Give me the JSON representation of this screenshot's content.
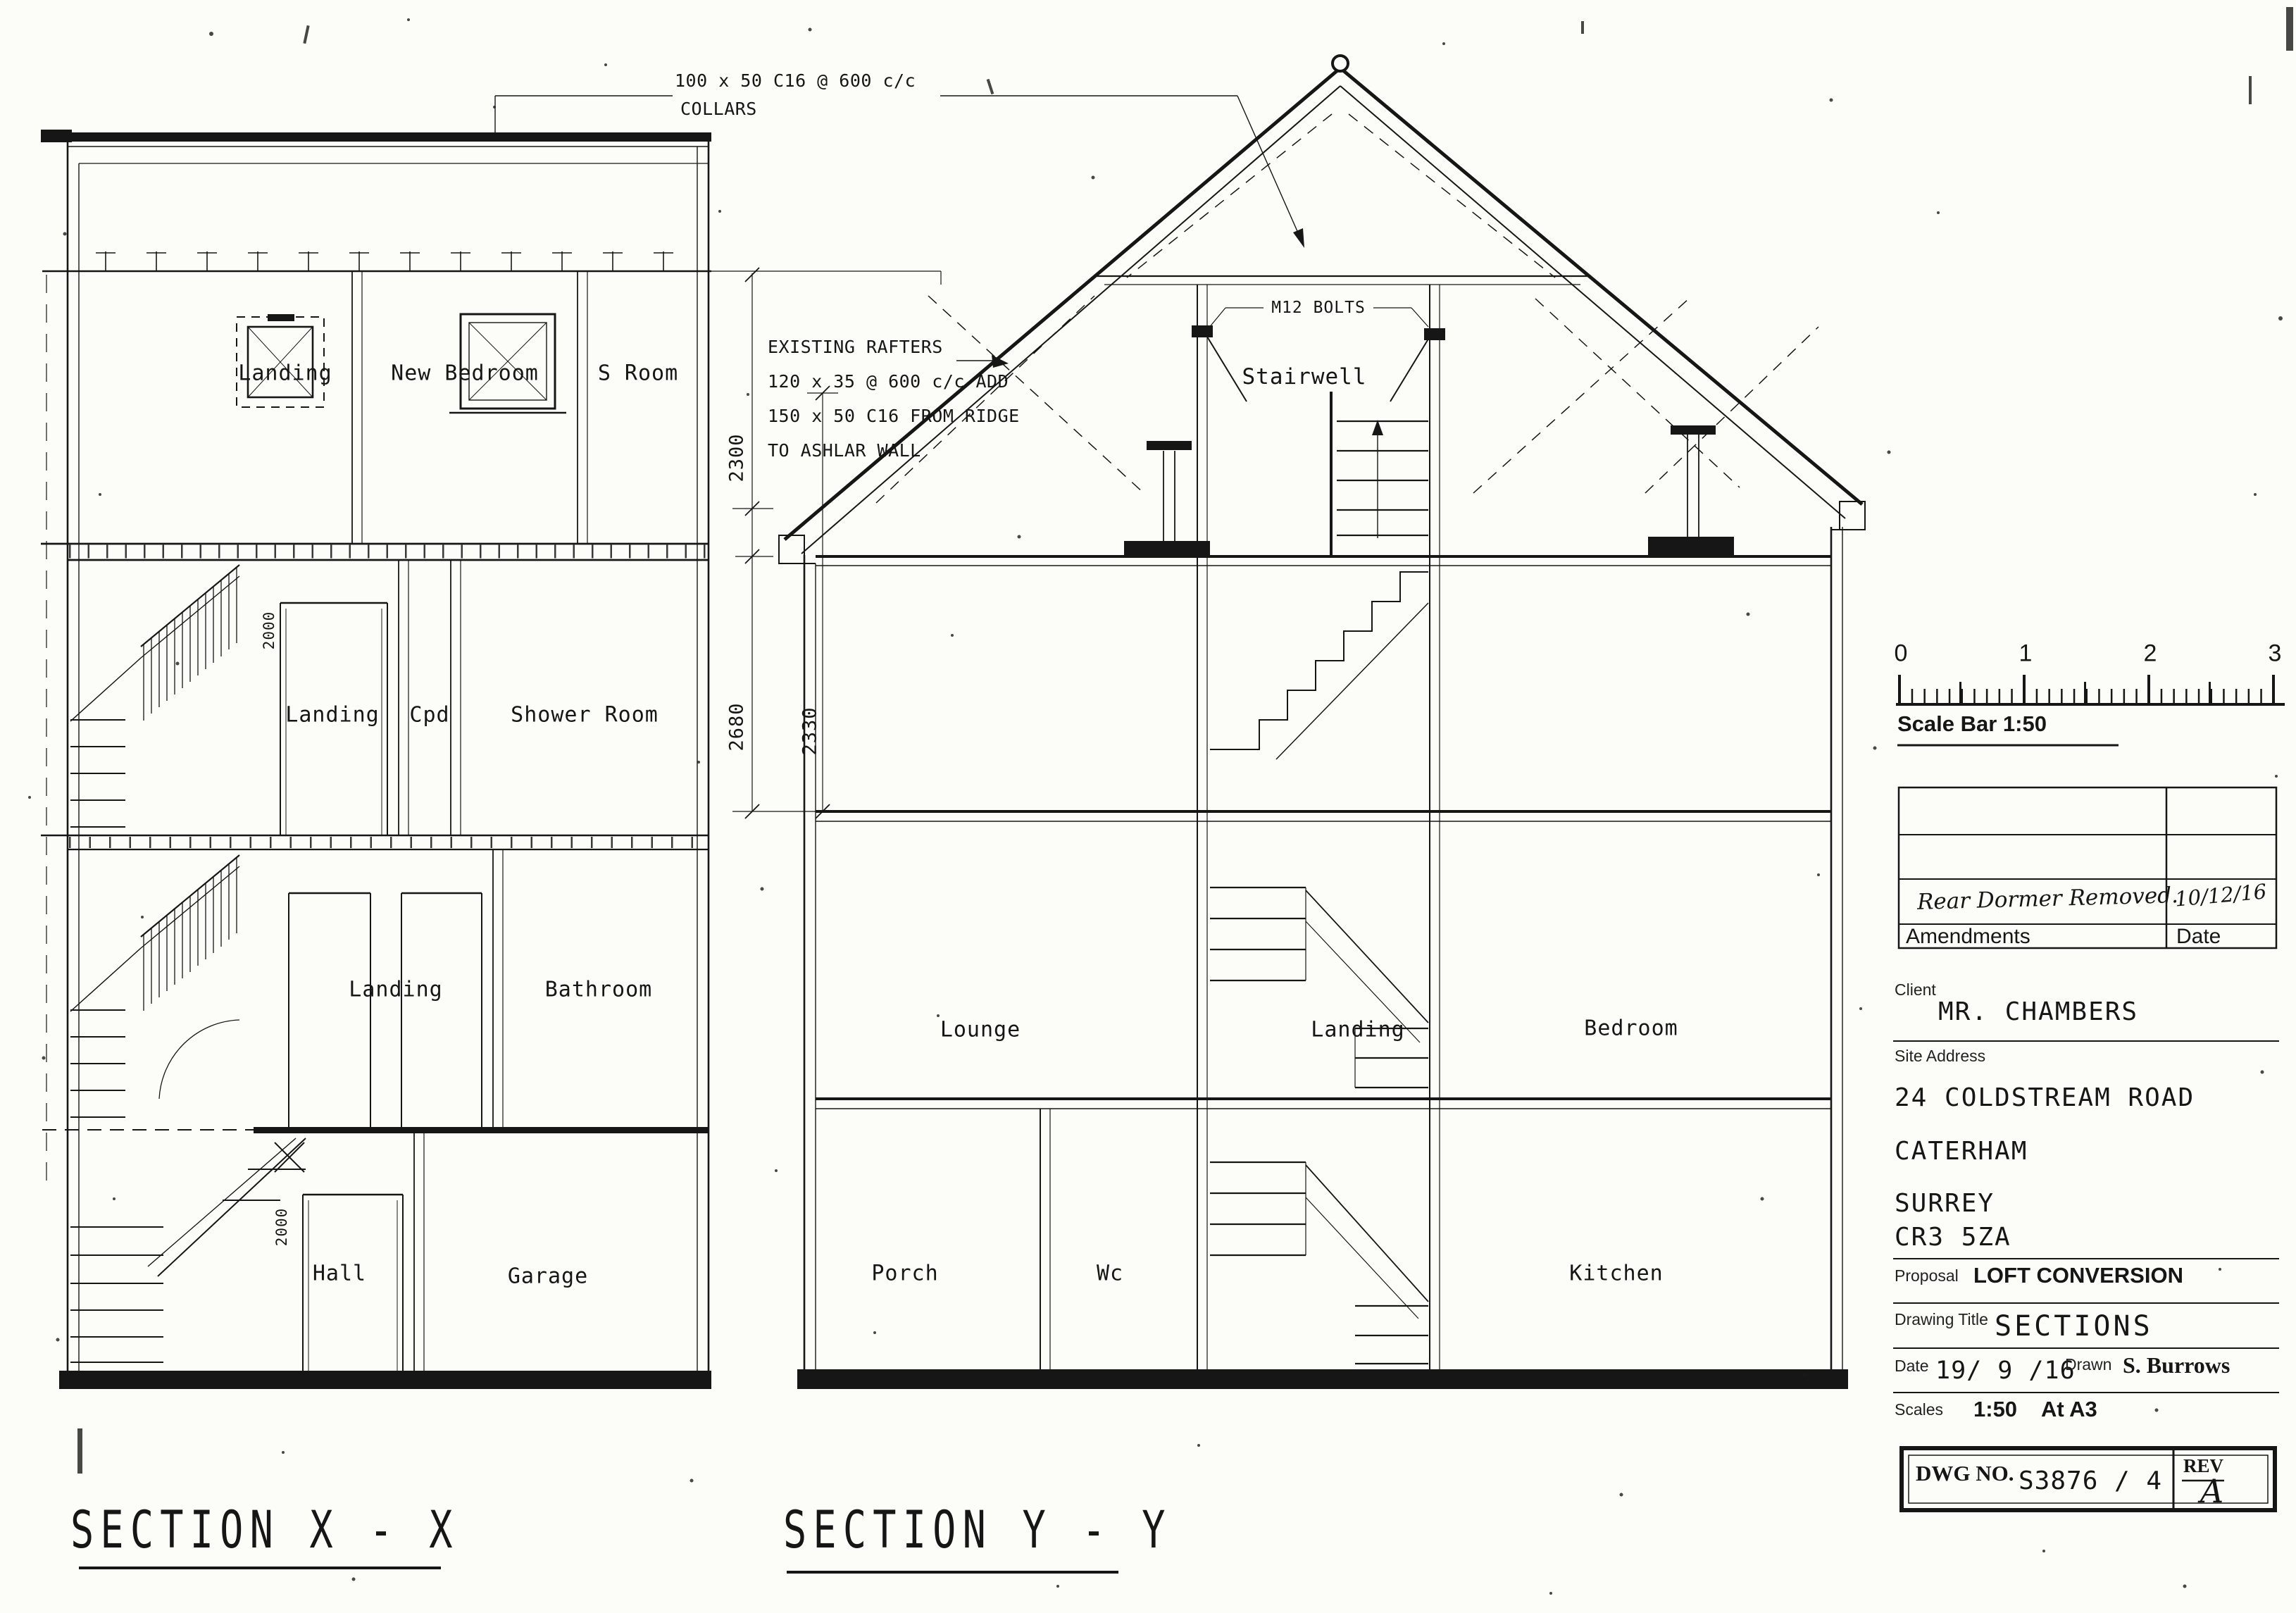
{
  "annotations": {
    "collars_1": "100 x 50 C16 @ 600 c/c",
    "collars_2": "COLLARS",
    "rafters_1": "EXISTING  RAFTERS",
    "rafters_2": "120 x 35 @ 600 c/c ADD",
    "rafters_3": "150 x 50 C16 FROM RIDGE",
    "rafters_4": "TO ASHLAR WALL",
    "bolts": "M12 BOLTS"
  },
  "dimensions": {
    "loft_head": "2300",
    "first_floor": "2680",
    "ashlar": "2330",
    "door_upper": "2000",
    "door_ground": "2000"
  },
  "section_x": {
    "title": "SECTION X - X",
    "loft": [
      "Landing",
      "New Bedroom",
      "S Room"
    ],
    "second": [
      "Landing",
      "Cpd",
      "Shower Room"
    ],
    "first": [
      "Landing",
      "Bathroom"
    ],
    "ground": [
      "Hall",
      "Garage"
    ]
  },
  "section_y": {
    "title": "SECTION Y - Y",
    "loft": "Stairwell",
    "first": [
      "Lounge",
      "Landing",
      "Bedroom"
    ],
    "ground": [
      "Porch",
      "Wc",
      "Kitchen"
    ]
  },
  "title_block": {
    "scale_bar": {
      "numbers": [
        "0",
        "1",
        "2",
        "3"
      ],
      "label": "Scale Bar 1:50"
    },
    "amendments": {
      "header": "Amendments",
      "date_header": "Date",
      "entry_text": "Rear Dormer Removed.",
      "entry_date": "10/12/16"
    },
    "client": {
      "label": "Client",
      "value": "MR. CHAMBERS"
    },
    "site_address": {
      "label": "Site Address",
      "lines": [
        "24 COLDSTREAM ROAD",
        "CATERHAM",
        "SURREY",
        "CR3 5ZA"
      ]
    },
    "proposal": {
      "label": "Proposal",
      "value": "LOFT CONVERSION"
    },
    "drawing_title": {
      "label": "Drawing Title",
      "value": "SECTIONS"
    },
    "date": {
      "label": "Date",
      "value": "19/ 9 /16"
    },
    "drawn": {
      "label": "Drawn",
      "value": "S. Burrows"
    },
    "scales": {
      "label": "Scales",
      "value": "1:50",
      "sheet": "At A3"
    },
    "dwg": {
      "label": "DWG NO.",
      "value": "S3876 / 4",
      "rev_label": "REV",
      "rev_value": "A"
    }
  }
}
